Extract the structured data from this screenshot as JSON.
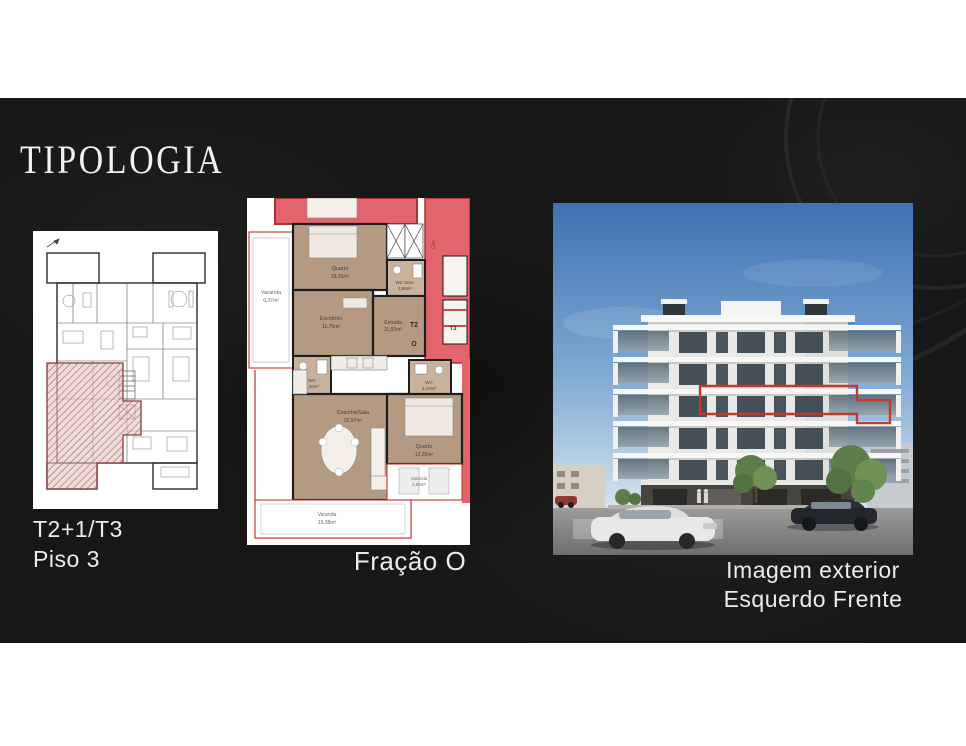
{
  "slide": {
    "title": "TIPOLOGIA"
  },
  "plans": {
    "overview": {
      "caption_line1": "T2+1/T3",
      "caption_line2": "Piso 3"
    },
    "fraction": {
      "caption": "Fração O",
      "unit_labels": {
        "t2": "T2",
        "fraction_letter": "O",
        "t3": "T3",
        "circulation": "Circ."
      },
      "rooms": {
        "varanda_left": {
          "name": "Varanda",
          "area": "6,37m²"
        },
        "quarto_top": {
          "name": "Quarto",
          "area": "19,35m²"
        },
        "wc_serv": {
          "name": "WC Serv.",
          "area": "3,96m²"
        },
        "escritorio": {
          "name": "Escritório",
          "area": "11,76m²"
        },
        "entrada": {
          "name": "Entrada",
          "area": "11,50m²"
        },
        "wc": {
          "name": "WC",
          "area": "4,36m²"
        },
        "cozinha_sala": {
          "name": "Cozinha/Sala",
          "area": "22,97m²"
        },
        "wc_social": {
          "name": "WC",
          "area": "3,44m²"
        },
        "quarto_right": {
          "name": "Quarto",
          "area": "12,20m²"
        },
        "varanda_right": {
          "name": "Varanda",
          "area": "4,95m²"
        },
        "varanda_bottom": {
          "name": "Varanda",
          "area": "19,38m²"
        }
      }
    },
    "exterior": {
      "caption_line1": "Imagem exterior",
      "caption_line2": "Esquerdo Frente"
    }
  },
  "colors": {
    "accent_red": "#c23a2c",
    "plan_red": "#e2646c",
    "plan_tan": "#b59a83",
    "slide_bg": "#171717"
  }
}
